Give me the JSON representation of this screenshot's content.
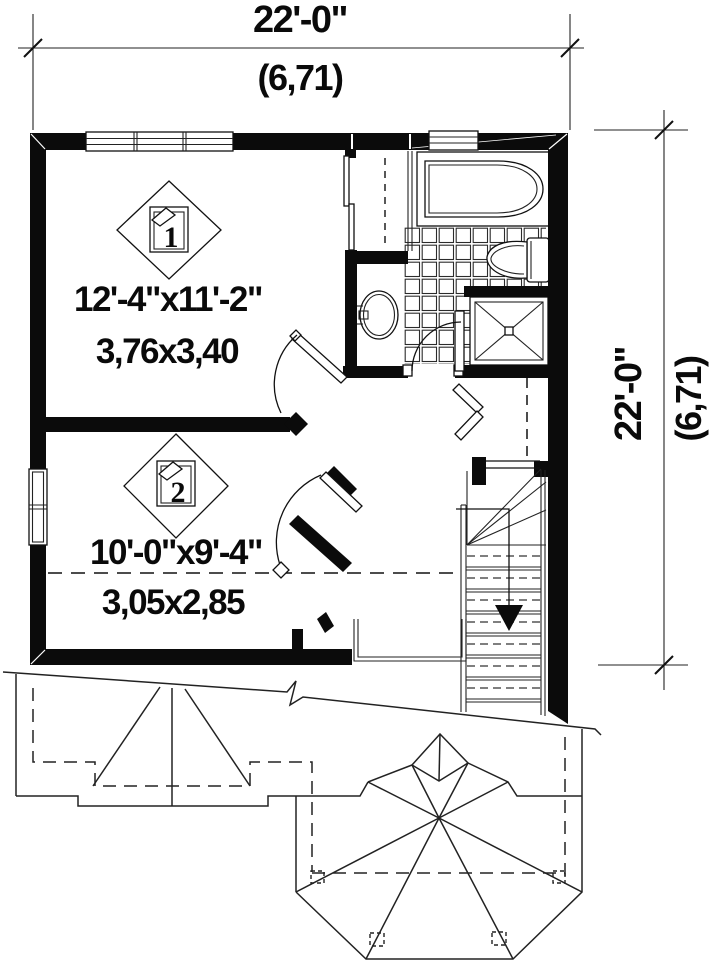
{
  "document": {
    "type": "floor-plan-drawing"
  },
  "colors": {
    "ink": "#111111",
    "wall_fill": "#0b0b0b",
    "paper": "#ffffff"
  },
  "dimensions": {
    "top": {
      "imperial": "22'-0\"",
      "metric": "(6,71)"
    },
    "right": {
      "imperial": "22'-0\"",
      "metric": "(6,71)"
    }
  },
  "rooms": [
    {
      "tag": "1",
      "imperial": "12'-4\"x11'-2\"",
      "metric": "3,76x3,40"
    },
    {
      "tag": "2",
      "imperial": "10'-0\"x9'-4\"",
      "metric": "3,05x2,85"
    }
  ],
  "icons": {
    "room_marker": "diamond-room-tag-icon",
    "stair_direction": "down-arrow-icon"
  }
}
